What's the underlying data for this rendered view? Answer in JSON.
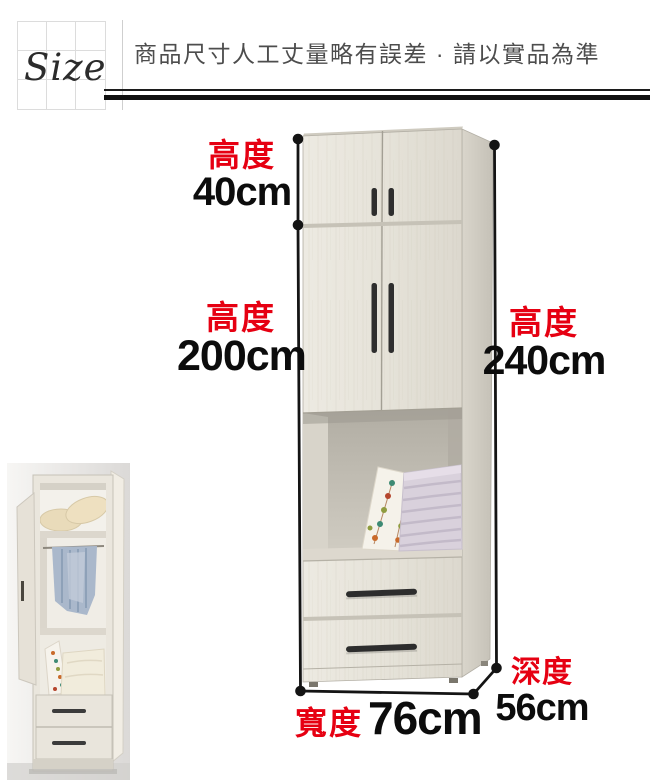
{
  "header": {
    "size_label": "Size",
    "notice": "商品尺寸人工丈量略有誤差 · 請以實品為準"
  },
  "colors": {
    "accent_red": "#e60012",
    "dimension_line_black": "#141414",
    "wood_front": "#e7e4db",
    "wood_side": "#cec9bf"
  },
  "dimensions": {
    "top_height": {
      "label": "高度",
      "value": "40cm"
    },
    "cabinet_height": {
      "label": "高度",
      "value": "200cm"
    },
    "total_height": {
      "label": "高度",
      "value": "240cm"
    },
    "width": {
      "label": "寬度",
      "value": "76cm"
    },
    "depth": {
      "label": "深度",
      "value": "56cm"
    }
  }
}
